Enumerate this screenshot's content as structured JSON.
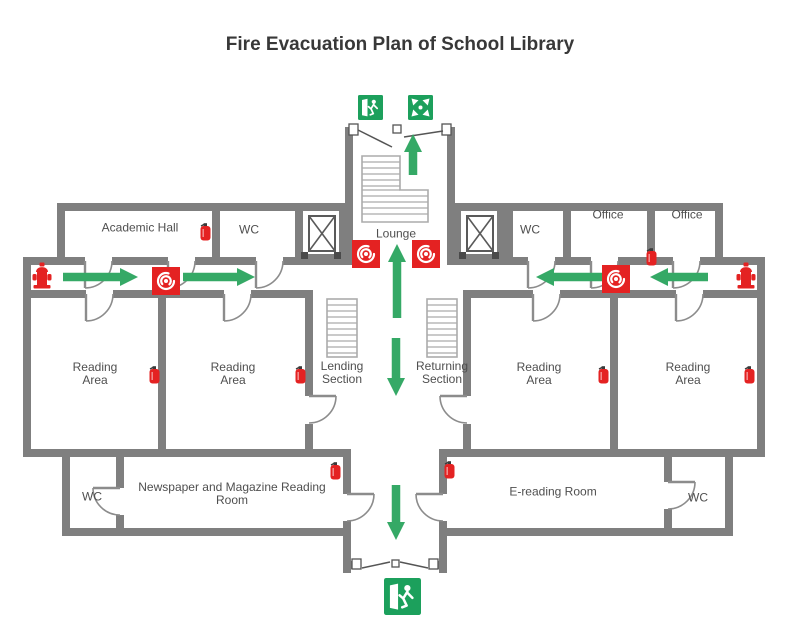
{
  "title": "Fire Evacuation Plan of School Library",
  "colors": {
    "wall": "#7f7f7f",
    "route": "#35a966",
    "sign": "#1ca05c",
    "safety": "#e42222",
    "label": "#4f4f4f",
    "title_color": "#383838"
  },
  "rooms": {
    "academic_hall": "Academic Hall",
    "wc_top_left": "WC",
    "lounge": "Lounge",
    "wc_top_right": "WC",
    "office_1": "Office",
    "office_2": "Office",
    "reading_area_1": "Reading Area",
    "reading_area_2": "Reading Area",
    "lending_section": "Lending Section",
    "returning_section": "Returning Section",
    "reading_area_3": "Reading Area",
    "reading_area_4": "Reading Area",
    "wc_bottom_left": "WC",
    "newspaper_room": "Newspaper and Magazine Reading Room",
    "e_reading_room": "E-reading Room",
    "wc_bottom_right": "WC"
  },
  "symbols": {
    "exit_sign": "emergency-exit-sign",
    "assembly_sign": "assembly-point-sign",
    "fire_extinguisher": "fire-extinguisher",
    "fire_alarm": "fire-alarm-call-point",
    "fire_hydrant": "fire-hydrant",
    "elevator": "elevator",
    "stairs": "stairs",
    "route_arrow": "evacuation-route-arrow"
  }
}
